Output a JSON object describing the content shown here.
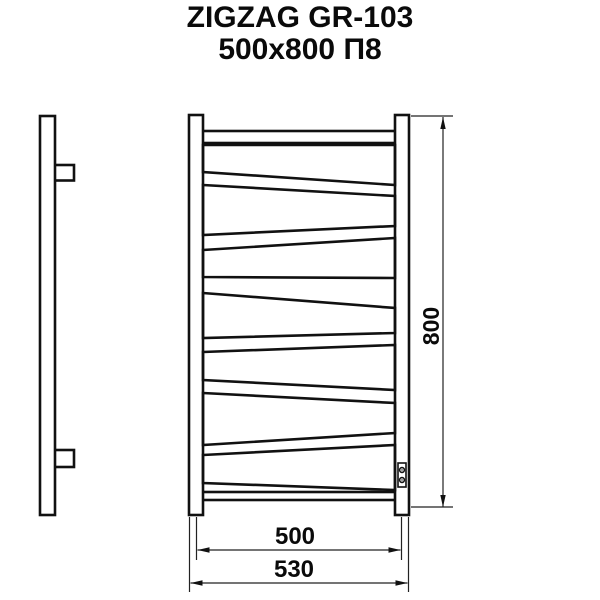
{
  "title": {
    "line1": "ZIGZAG GR-103",
    "line2": "500x800 П8"
  },
  "dimensions": {
    "height": "800",
    "rail_width": "500",
    "overall_width": "530"
  },
  "colors": {
    "line": "#111111",
    "dim_line": "#222222",
    "background": "#ffffff"
  }
}
